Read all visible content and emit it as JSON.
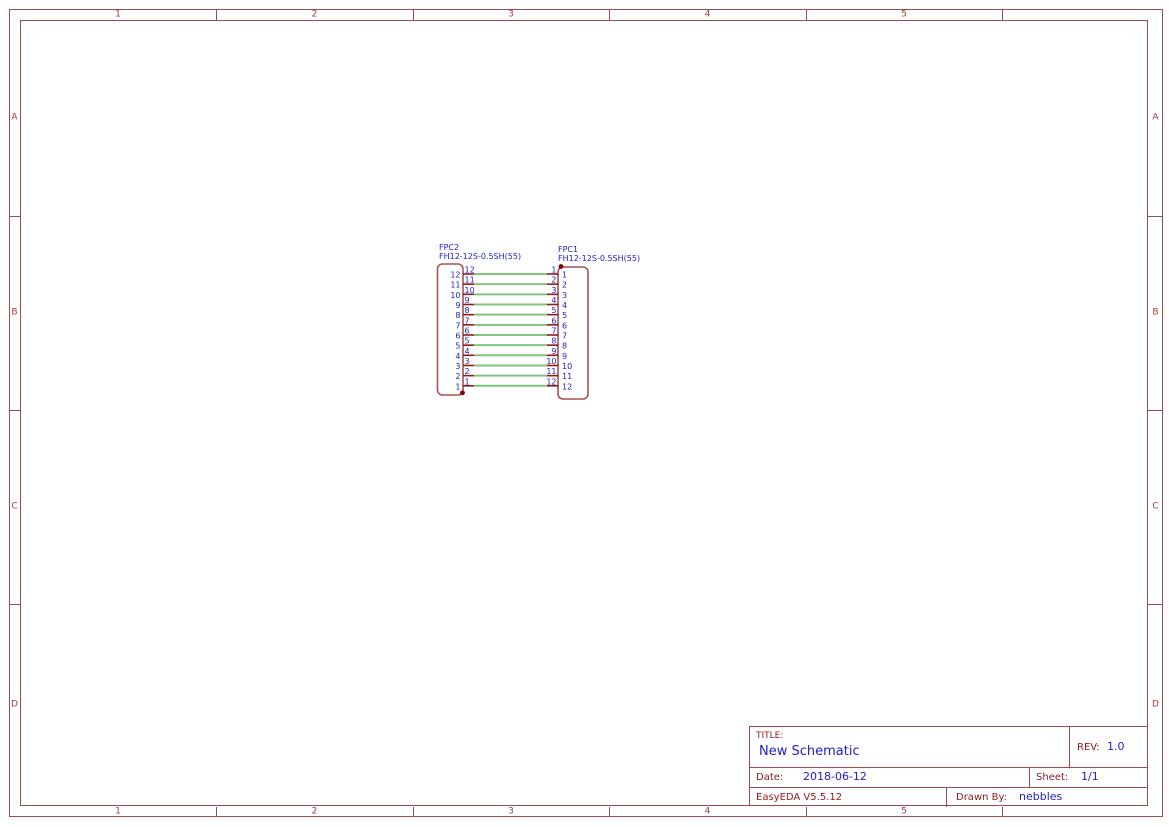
{
  "colors": {
    "frame": "#9E4A4A",
    "frame_text": "#9C3C3C",
    "label_red": "#8B1C1C",
    "value_blue": "#2020C8",
    "wire_green": "#82C382",
    "pin_stub_red": "#8B1A1A",
    "body_outline": "#A35454",
    "anchor_dot_red": "#7E0000",
    "background": "#FFFFFF"
  },
  "frame": {
    "columns": [
      "1",
      "2",
      "3",
      "4",
      "5"
    ],
    "rows": [
      "A",
      "B",
      "C",
      "D"
    ]
  },
  "schematic": {
    "wire_count": 12,
    "components": [
      {
        "ref": "FPC2",
        "value": "FH12-12S-0.5SH(55)",
        "pins_top_to_bottom": [
          "12",
          "11",
          "10",
          "9",
          "8",
          "7",
          "6",
          "5",
          "4",
          "3",
          "2",
          "1"
        ]
      },
      {
        "ref": "FPC1",
        "value": "FH12-12S-0.5SH(55)",
        "pins_top_to_bottom": [
          "1",
          "2",
          "3",
          "4",
          "5",
          "6",
          "7",
          "8",
          "9",
          "10",
          "11",
          "12"
        ]
      }
    ]
  },
  "title_block": {
    "title_label": "TITLE:",
    "title": "New Schematic",
    "rev_label": "REV:",
    "rev": "1.0",
    "date_label": "Date:",
    "date": "2018-06-12",
    "sheet_label": "Sheet:",
    "sheet": "1/1",
    "software": "EasyEDA V5.5.12",
    "drawn_by_label": "Drawn By:",
    "drawn_by": "nebbles"
  }
}
